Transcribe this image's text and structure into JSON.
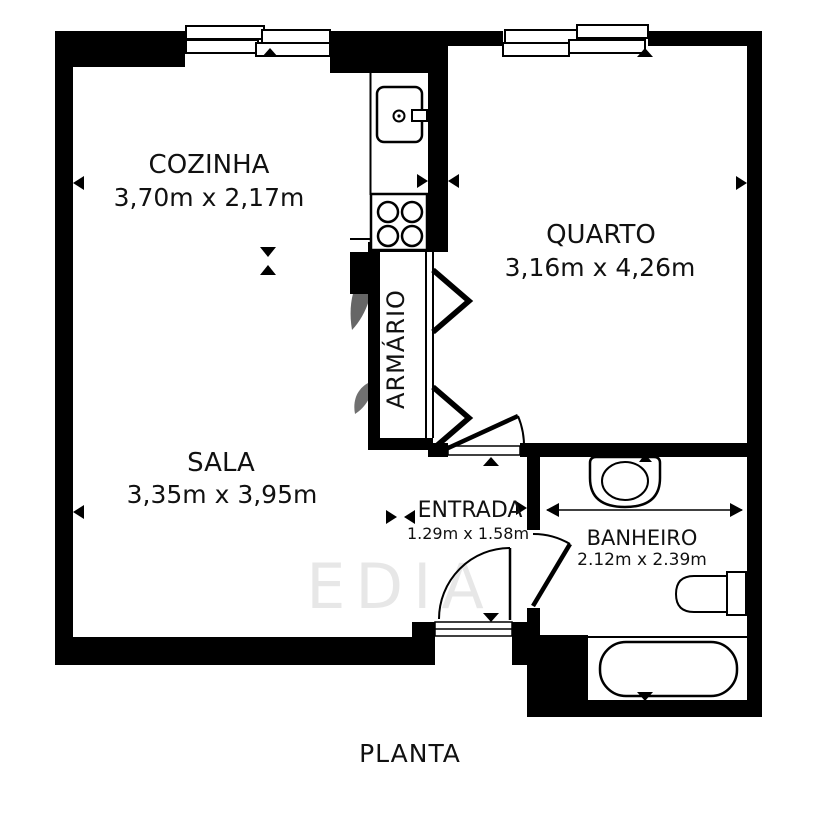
{
  "plan": {
    "caption": "PLANTA",
    "watermark": "EDIA",
    "colors": {
      "wall": "#000000",
      "background": "#ffffff",
      "text": "#111111"
    },
    "rooms": [
      {
        "name": "COZINHA",
        "dims": "3,70m x 2,17m"
      },
      {
        "name": "QUARTO",
        "dims": "3,16m x 4,26m"
      },
      {
        "name": "SALA",
        "dims": "3,35m x 3,95m"
      },
      {
        "name": "ENTRADA",
        "dims": "1.29m x 1.58m"
      },
      {
        "name": "BANHEIRO",
        "dims": "2.12m x 2.39m"
      },
      {
        "name": "ARMÁRIO",
        "dims": ""
      }
    ],
    "fixtures": [
      "fridge",
      "stove-4-burners",
      "closet-bifold-doors",
      "sink",
      "toilet",
      "bathtub"
    ],
    "windows": [
      "cozinha-sliding-window",
      "quarto-sliding-window"
    ],
    "doors": [
      "entry-door",
      "quarto-door",
      "banheiro-door"
    ]
  }
}
